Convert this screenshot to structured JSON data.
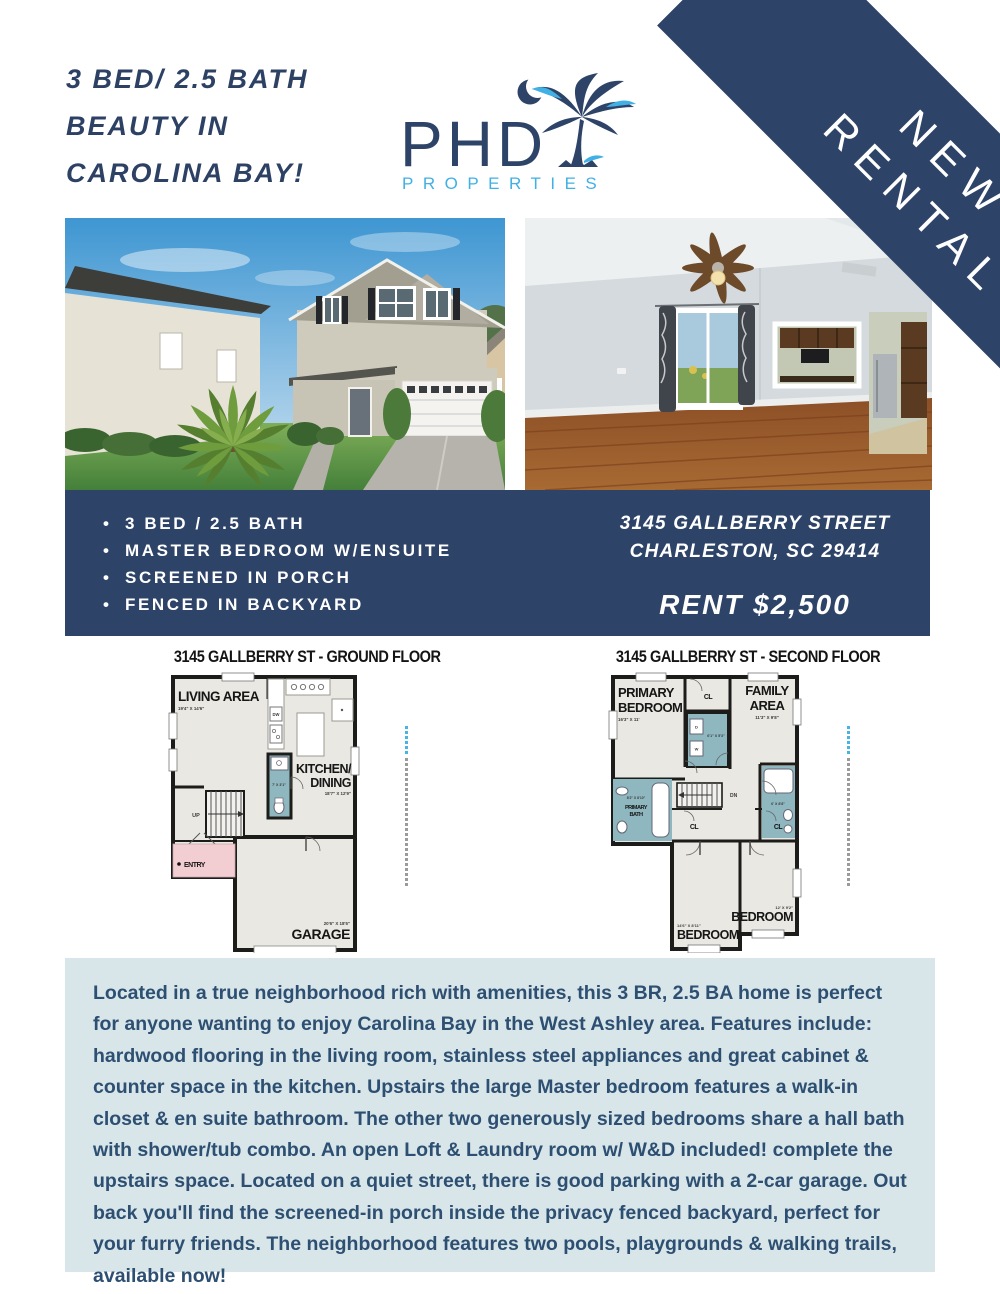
{
  "header": {
    "title_lines": [
      "3 BED/ 2.5 BATH",
      "BEAUTY IN",
      "CAROLINA BAY!"
    ]
  },
  "logo": {
    "name": "PHD",
    "subtitle": "PROPERTIES"
  },
  "ribbon": {
    "line1": "NEW",
    "line2": "RENTAL"
  },
  "highlights": {
    "items": [
      "3 BED / 2.5 BATH",
      "MASTER BEDROOM W/ENSUITE",
      "SCREENED IN PORCH",
      "FENCED IN BACKYARD"
    ]
  },
  "address": {
    "line1": "3145 GALLBERRY STREET",
    "line2": "CHARLESTON, SC 29414",
    "rent": "RENT $2,500"
  },
  "floorplans": {
    "ground": {
      "title": "3145 GALLBERRY ST - GROUND FLOOR",
      "living_name": "LIVING AREA",
      "living_dims": "19'4\" X 14'6\"",
      "kitchen_name1": "KITCHEN/",
      "kitchen_name2": "DINING",
      "kitchen_dims": "18'7\" X 12'9\"",
      "bath_dims": "7' X 3'1\"",
      "garage_name": "GARAGE",
      "garage_dims": "20'6\" X 18'5\"",
      "entry": "ENTRY",
      "closet": "CL",
      "stairs": "UP",
      "dw": "DW"
    },
    "second": {
      "title": "3145 GALLBERRY ST - SECOND FLOOR",
      "primary1": "PRIMARY",
      "primary2": "BEDROOM",
      "primary_dims": "16'3\" X 11'",
      "family1": "FAMILY",
      "family2": "AREA",
      "family_dims": "11'3\" X 9'8\"",
      "laundry_dims": "6'1\" X 5'3\"",
      "pbath1": "PRIMARY",
      "pbath2": "BATH",
      "pbath_dims": "8'2\" X 8'10\"",
      "hallbath_dims": "6' X 8'8\"",
      "bed1_name": "BEDROOM",
      "bed1_dims": "14'6\" X 8'11\"",
      "bed2_name": "BEDROOM",
      "bed2_dims": "12' X 9'2\"",
      "closet": "CL",
      "stairs": "DN",
      "washer": "W",
      "dryer": "D"
    }
  },
  "description": {
    "text": "Located in a true neighborhood rich with amenities, this 3 BR, 2.5 BA home is perfect for anyone wanting to enjoy Carolina Bay in the West Ashley area. Features include: hardwood flooring in the living room, stainless steel appliances and great cabinet & counter space in the kitchen. Upstairs the large Master bedroom features a walk-in closet & en suite bathroom. The other two generously sized bedrooms share a hall bath with shower/tub combo. An open Loft & Laundry room w/ W&D included! complete the upstairs space. Located on a quiet street, there is good parking with a 2-car garage. Out back you'll find the screened-in porch inside the privacy fenced backyard, perfect for your furry friends. The neighborhood features two pools, playgrounds & walking trails, available now!"
  },
  "colors": {
    "navy": "#2e4368",
    "light_blue": "#41b0e4",
    "desc_bg": "#d8e5e9",
    "desc_text": "#2d4f72"
  }
}
